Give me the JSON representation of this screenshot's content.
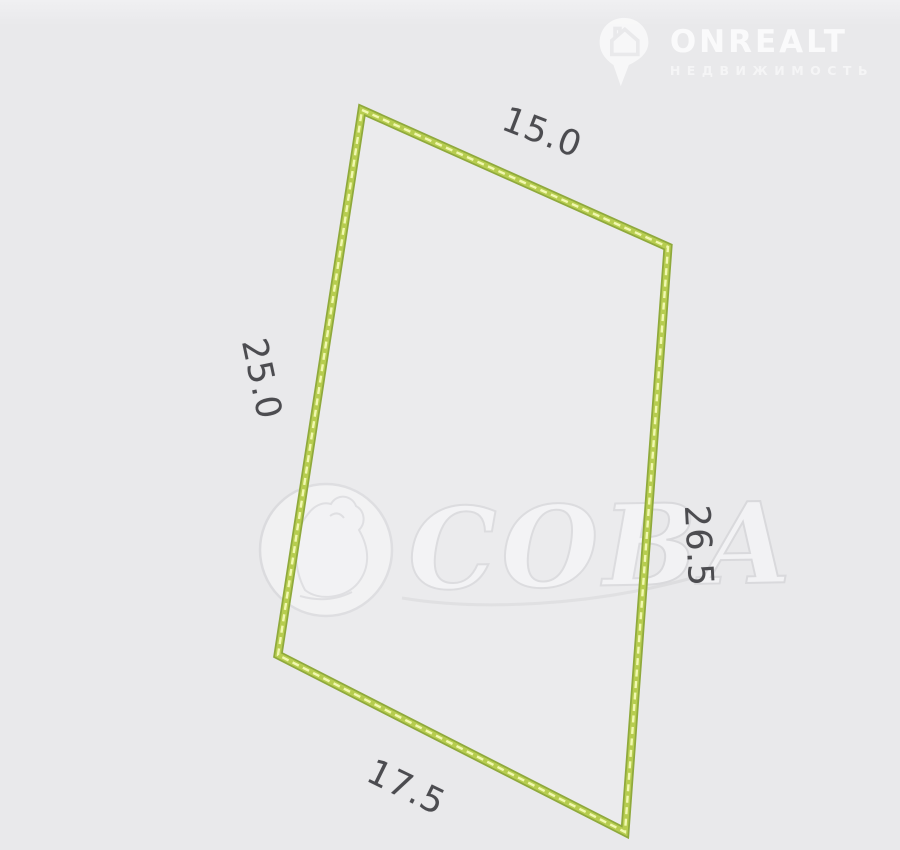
{
  "brand": {
    "name": "ONREALT",
    "tagline": "НЕДВИЖИМОСТЬ",
    "icon": "map-pin-house-icon"
  },
  "watermark": {
    "agency": "СОВА",
    "emblem": "owl-in-circle-icon"
  },
  "plot": {
    "type": "land-plot-outline",
    "shape": "quadrilateral",
    "dimensions": {
      "top": "15.0",
      "left": "25.0",
      "right": "26.5",
      "bottom": "17.5"
    },
    "outline_color": "#9cb441",
    "dash_color": "#f1f8b0"
  },
  "colors": {
    "background": "#e9e9eb",
    "dimension_text": "#4c4c50"
  }
}
